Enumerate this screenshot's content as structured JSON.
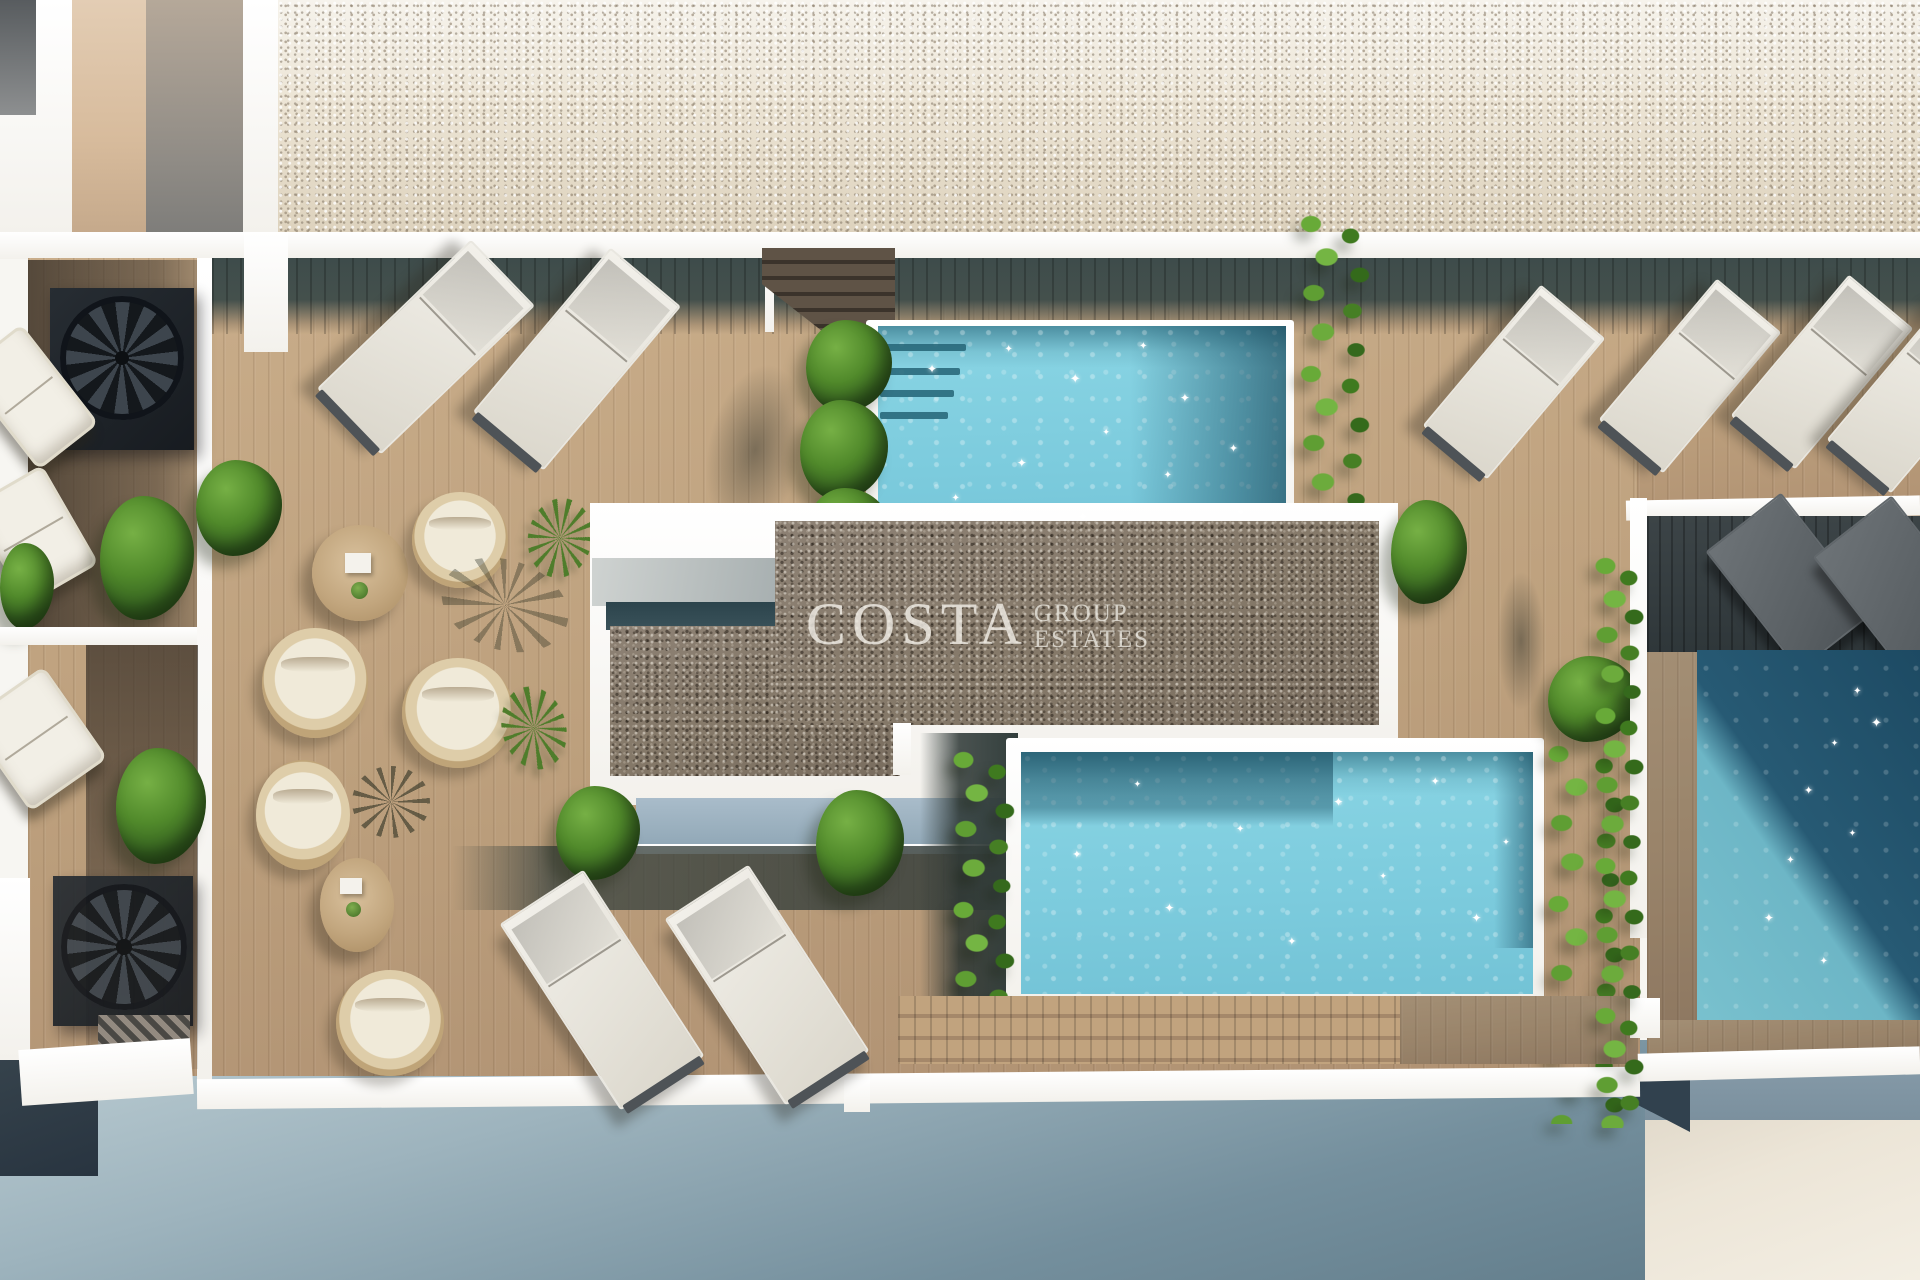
{
  "watermark": {
    "title": "COSTA",
    "subtitle_line1": "GROUP",
    "subtitle_line2": "ESTATES"
  },
  "palette": {
    "deck_wood": "#bfa17e",
    "deck_shadow_band": "#42504e",
    "roof_gravel_light": "#e7dfd0",
    "court_gravel_dark": "#867a6c",
    "pool_water_light": "#8ad5e4",
    "pool_water_deep": "#1d4a63",
    "plant_green": "#4e8328",
    "wall_white": "#f7f6f2",
    "ground_shadow_blue": "#6d8593",
    "ground_warm_beige": "#ece5d7"
  },
  "scene": {
    "setting": "aerial-3d-render-rooftop-pool-terrace",
    "pools": [
      {
        "label": "upper-pool",
        "water": "light-turquoise",
        "features": [
          "entry-steps",
          "star-glints",
          "plant-shadow-right"
        ]
      },
      {
        "label": "lower-pool",
        "water": "light-turquoise",
        "features": [
          "dark-shadow-top",
          "star-glints",
          "vine-edges"
        ]
      },
      {
        "label": "right-pool",
        "water": "deep-blue",
        "features": [
          "diagonal-sun-shadow",
          "star-glints"
        ]
      }
    ],
    "furniture": {
      "sun_loungers_white": 8,
      "sun_loungers_dark": 2,
      "round_lounge_chairs": 5,
      "round_tables": 2,
      "outdoor_sofas": 3,
      "spiral_staircases": 2
    }
  }
}
